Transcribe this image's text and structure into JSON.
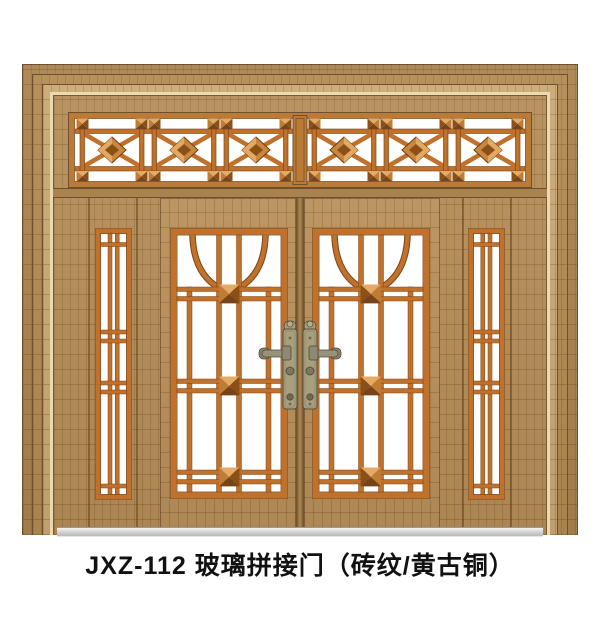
{
  "caption": {
    "text": "JXZ-112 玻璃拼接门（砖纹/黄古铜）"
  },
  "product": {
    "code": "JXZ-112",
    "type_name": "玻璃拼接门",
    "finish": "砖纹/黄古铜"
  },
  "colors": {
    "background": "#ffffff",
    "brick_base": "#b58d56",
    "brick_band_dark": "#a9834e",
    "brick_band_light": "#c9a873",
    "trim_highlight": "#ead9b1",
    "muntin_copper": "#c0722c",
    "copper_dark": "#7d4514",
    "frame_line_dark": "#6e5030",
    "glass": "#ffffff",
    "handle_bronze": "#a89f7d",
    "threshold_gray": "#cfcfcf",
    "caption_text": "#111111"
  }
}
